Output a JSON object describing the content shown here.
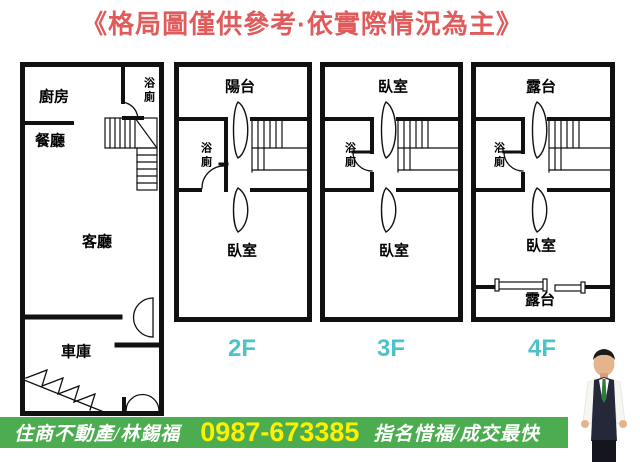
{
  "title": {
    "text": "《格局圖僅供參考·依實際情況為主》"
  },
  "floors": {
    "f1": {
      "kitchen": "廚房",
      "dining": "餐廳",
      "bath": "浴廁",
      "living": "客廳",
      "garage": "車庫"
    },
    "f2": {
      "label": "2F",
      "top": "陽台",
      "bath": "浴廁",
      "bottom": "臥室"
    },
    "f3": {
      "label": "3F",
      "top": "臥室",
      "bath": "浴廁",
      "bottom": "臥室"
    },
    "f4": {
      "label": "4F",
      "top": "露台",
      "bath": "浴廁",
      "bottom": "臥室",
      "terrace": "露台"
    }
  },
  "footer": {
    "agency": "住商不動產/林錫福",
    "phone": "0987-673385",
    "tagline": "指名惜福/成交最快"
  },
  "colors": {
    "title_red": "#e05c5c",
    "floor_label_cyan": "#4cc2ca",
    "footer_green": "#4bad4f",
    "phone_yellow": "#fdf000",
    "wall_black": "#111111"
  }
}
